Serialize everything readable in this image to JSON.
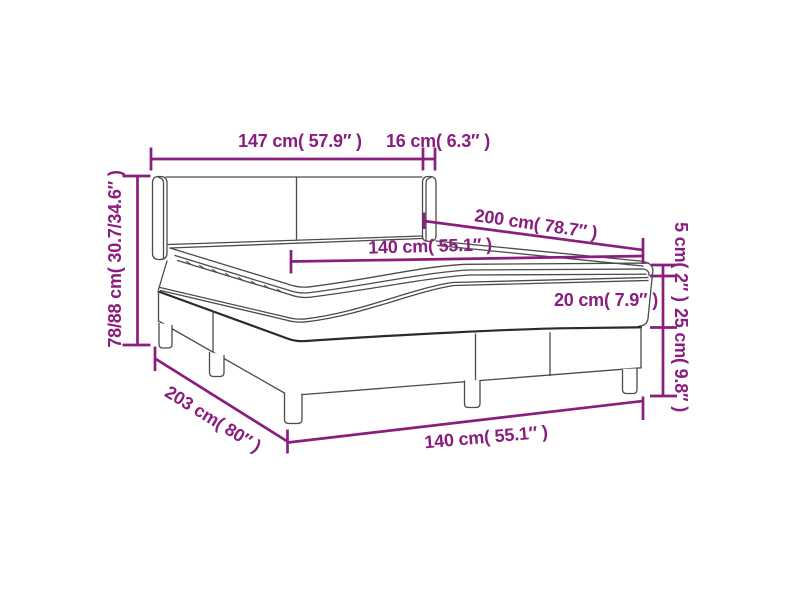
{
  "page": {
    "background_color": "#ffffff"
  },
  "diagram": {
    "subject": "box-spring-bed-dimension-diagram",
    "colors": {
      "dimension_accent": "#8A1E7E",
      "bed_outline": "#4B4B4B",
      "bed_outline_dark": "#2B2B2B"
    },
    "dimensions": {
      "headboard_width": "147 cm( 57.9″ )",
      "headboard_side_depth": "16 cm( 6.3″ )",
      "bed_length": "200 cm( 78.7″ )",
      "mattress_width": "140 cm( 55.1″ )",
      "total_height": "78/88 cm( 30.7/34.6″ )",
      "topper_height": "5 cm( 2″ )",
      "mattress_height": "20 cm( 7.9″ )",
      "base_height": "25 cm( 9.8″ )",
      "frame_length": "203 cm( 80″ )",
      "frame_width": "140 cm( 55.1″ )"
    }
  }
}
